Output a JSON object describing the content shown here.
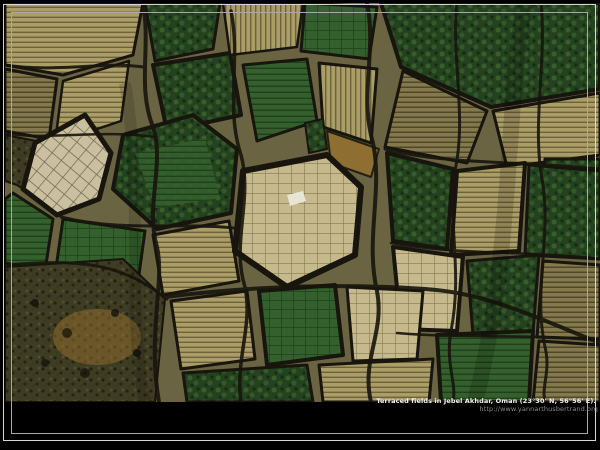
{
  "window": {
    "width": 600,
    "height": 450
  },
  "caption": {
    "title": "Terraced fields in Jebel Akhdar, Oman (23°30' N, 56°56' E).",
    "url": "http://www.yannarthusbertrand.org"
  },
  "photo": {
    "subject": "aerial view of terraced fields, Jebel Akhdar, Oman"
  },
  "palette": {
    "background": "#000000",
    "frame_line": "#d6d6d6",
    "frame_line_inner": "#a8a8a8",
    "caption_text": "#f0f0f0",
    "caption_url": "#8c8c8c",
    "field_green_dark": "#24421f",
    "field_green": "#33602c",
    "field_green_light": "#4a7a38",
    "terrace_tan": "#ab9d66",
    "terrace_tan_light": "#c6b98c",
    "terrace_tan_dark": "#84794c",
    "soil_olive": "#6b6443",
    "scrub": "#3f3c24",
    "path_dark": "#17150d",
    "orange_soil": "#95702e",
    "white_spot": "#e9e5d6"
  }
}
